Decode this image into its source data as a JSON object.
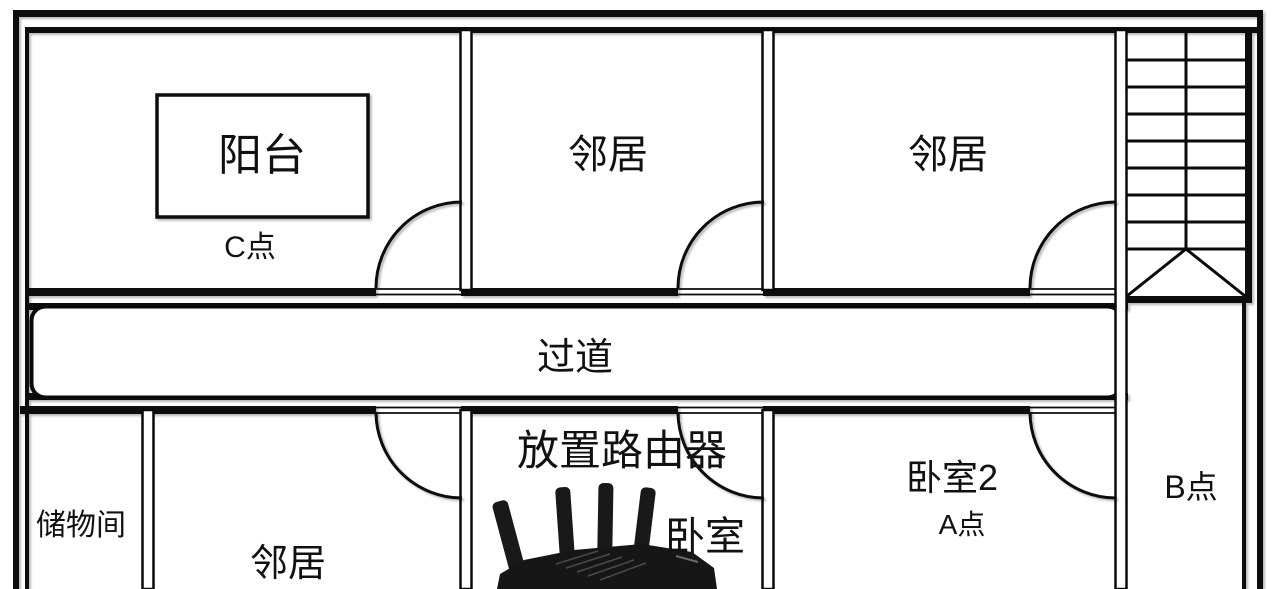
{
  "labels": {
    "balcony": "阳台",
    "point_c": "C点",
    "neighbor_top_left": "邻居",
    "neighbor_top_right": "邻居",
    "corridor": "过道",
    "storage_room": "储物间",
    "neighbor_bottom": "邻居",
    "router_placement": "放置路由器",
    "bedroom": "卧室",
    "bedroom_2": "卧室2",
    "point_a": "A点",
    "point_b": "B点"
  },
  "icons": {
    "router": "wifi-router",
    "staircase": "staircase-with-direction-arrows",
    "door": "quarter-circle-door-swing"
  },
  "colors": {
    "background": "#ffffff",
    "wall": "#0a0a0a",
    "text": "#111111",
    "router_body": "#161616"
  }
}
